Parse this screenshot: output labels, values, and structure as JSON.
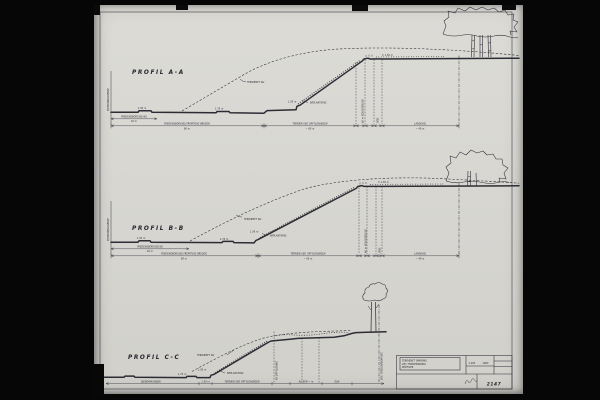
{
  "sheet": {
    "drawing_number": "2147",
    "scale": "1:200",
    "date": "1963",
    "title_line1": "TERRÆNET OMKRING",
    "title_line2": "VEJ I FREDENSBORG",
    "title_line3": "PROFILER"
  },
  "profiles": {
    "a": {
      "title": "PROFIL A-A",
      "terrain_now": "TERRÆNET NU",
      "planting": "BEPLANTNING",
      "boundary": "EJENDOMSGRÆNSE",
      "road_now": "FREDENSBORGVEJ NU",
      "road_now_value": "40 m",
      "future": "FREDENSBORGVEJ FREMTIDIG BREDDE",
      "future_value": "80 m",
      "fill": "TERRÆN VED OPFYLDNINGEN",
      "fill_value": "~ 60 m",
      "widening": "60 m VEJUDVIDELSE",
      "boundary_mark": "SKEL",
      "landevej": "LANDEVEJ",
      "landevej_value": "~ 40 m",
      "m1": "1.50 m",
      "m2": "1.70 m",
      "m3": "1.50 m",
      "m4": "± 1.50 m"
    },
    "b": {
      "title": "PROFIL B-B",
      "terrain_now": "TERRÆNET NU",
      "planting": "BEPLANTNING",
      "boundary": "EJENDOMSGRÆNSE",
      "road_now": "FREDENSBORGVEJ NU",
      "road_now_value": "40 m",
      "future": "FREDENSBORGVEJ FREMTIDIG BREDDE",
      "future_value": "80 m",
      "fill": "TERRÆN VED OPFYLDNINGEN",
      "fill_value": "~ 60 m",
      "widening": "60 m VEJUDVIDELSE",
      "boundary_mark": "SKEL",
      "landevej": "LANDEVEJ",
      "landevej_value": "~ 40 m",
      "m1": "1.50 m",
      "m2": "1.70 m",
      "m3": "1.50 m",
      "m4": "± 1.50 m"
    },
    "c": {
      "title": "PROFIL C-C",
      "terrain_now": "TERRÆNET NU",
      "planting": "BEPLANTNING",
      "rot1": "NY OPFYLDNING",
      "rot2": "EKS. FREDENSBORGVEJ",
      "d1": "EJENDOMSVEJEN",
      "d2": "1.50 m",
      "d3": "TERRÆN VED OPFYLDNINGEN",
      "d4": "ALLEEN ~ m",
      "d5": "ELM",
      "m1": "1.50 m",
      "m2": "1.70 m"
    }
  }
}
